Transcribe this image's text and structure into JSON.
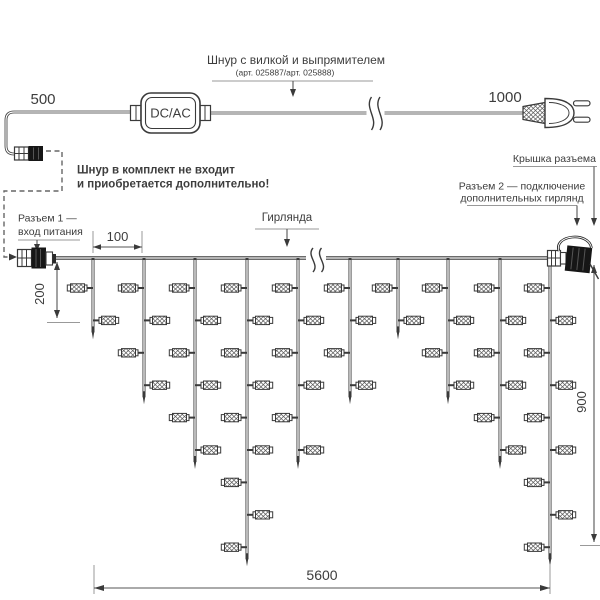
{
  "labels": {
    "cord_title": "Шнур с вилкой и выпрямителем",
    "cord_article": "(арт. 025887/арт. 025888)",
    "cord_note_line1": "Шнур в комплект не входит",
    "cord_note_line2": "и приобретается дополнительно!",
    "converter": "DC/AC",
    "connector1_line1": "Разъем 1 —",
    "connector1_line2": "вход питания",
    "cap_label": "Крышка разъема",
    "connector2_line1": "Разъем 2 — подключение",
    "connector2_line2": "дополнительных гирлянд",
    "garland_label": "Гирлянда"
  },
  "dimensions": {
    "cord_to_converter": "500",
    "converter_to_plug": "1000",
    "drop_spacing": "100",
    "first_drop_length": "200",
    "max_drop_length": "900",
    "garland_length": "5600"
  },
  "colors": {
    "background": "#ffffff",
    "line": "#3a3a3a",
    "text": "#3d3d3d",
    "annotation_gray": "#999999",
    "connector_black": "#161616"
  },
  "garland": {
    "wire_y": 258,
    "wire_start_x": 55,
    "wire_end_x": 556,
    "bulb_first_row_y": 288,
    "bulb_row_spacing": 32.4,
    "drop_tip_extra": 19,
    "drops": [
      {
        "x": 93,
        "bulbs": 2
      },
      {
        "x": 144,
        "bulbs": 4
      },
      {
        "x": 195,
        "bulbs": 6
      },
      {
        "x": 247,
        "bulbs": 9
      },
      {
        "x": 298,
        "bulbs": 6
      },
      {
        "x": 350,
        "bulbs": 4
      },
      {
        "x": 398,
        "bulbs": 2
      },
      {
        "x": 448,
        "bulbs": 4
      },
      {
        "x": 500,
        "bulbs": 6
      },
      {
        "x": 550,
        "bulbs": 9
      }
    ]
  }
}
